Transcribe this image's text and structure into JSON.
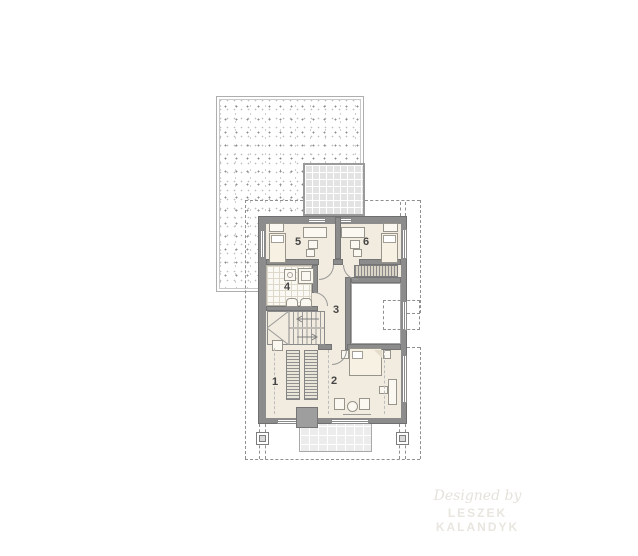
{
  "plan": {
    "title": "Upper floor plan",
    "rooms": [
      {
        "number": "1",
        "type": "wardrobe-hall"
      },
      {
        "number": "2",
        "type": "bedroom"
      },
      {
        "number": "3",
        "type": "hallway"
      },
      {
        "number": "4",
        "type": "bathroom"
      },
      {
        "number": "5",
        "type": "bedroom"
      },
      {
        "number": "6",
        "type": "bedroom"
      }
    ],
    "watermark": {
      "line1": "Designed by",
      "line2": "LESZEK KALANDYK"
    },
    "colors": {
      "wall": "#8c8c8c",
      "floor": "#f2ebdf",
      "terrace_tile": "#e3e3e3",
      "outline_dash": "#8f8f8f",
      "label_text": "#454545"
    }
  }
}
